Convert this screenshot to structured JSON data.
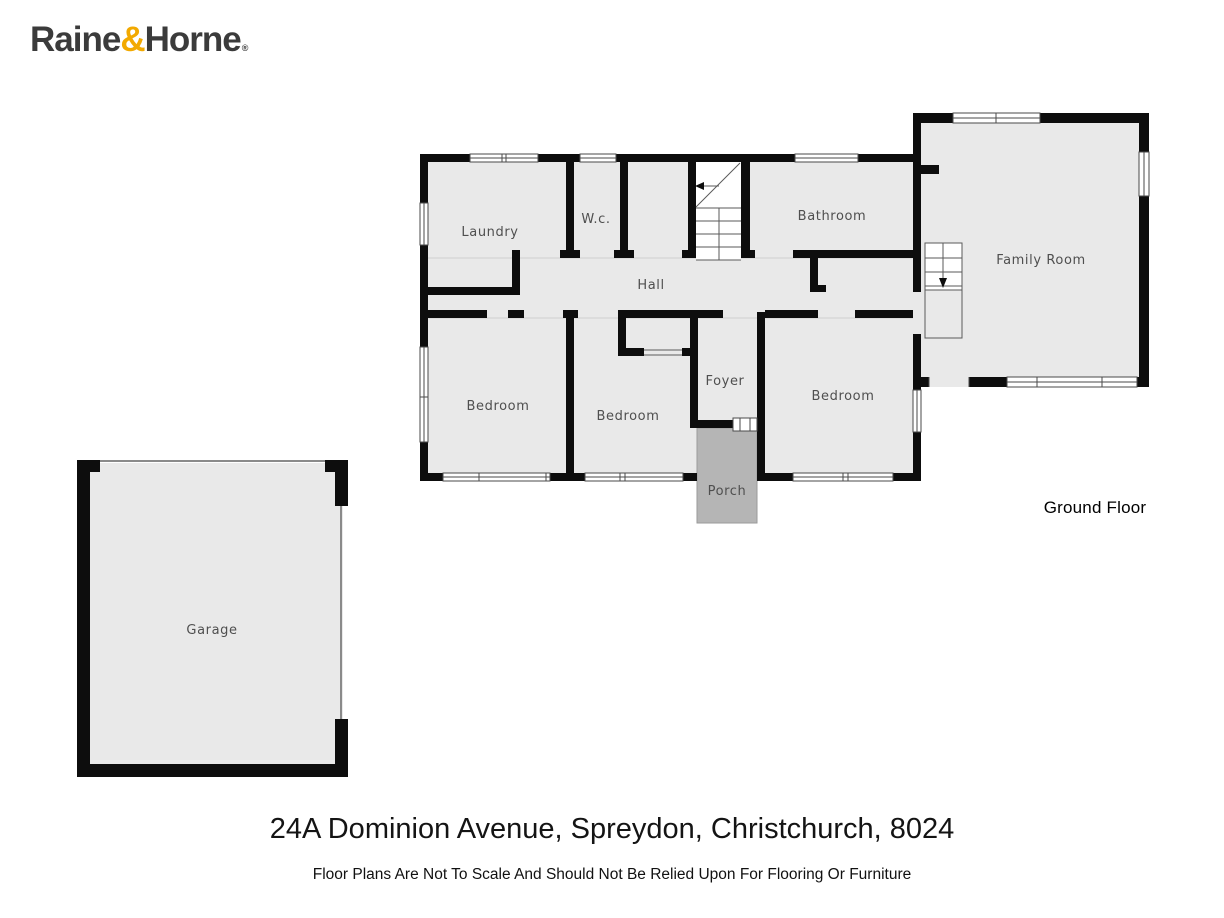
{
  "brand": {
    "name_part1": "Raine",
    "ampersand": "&",
    "name_part2": "Horne",
    "registered_mark": "®",
    "accent_color": "#F2A900",
    "text_color": "#3B3B3B"
  },
  "floorplan": {
    "floor_label": "Ground Floor",
    "rooms": {
      "laundry": "Laundry",
      "wc": "W.c.",
      "hall": "Hall",
      "bathroom": "Bathroom",
      "family_room": "Family Room",
      "bedroom_left": "Bedroom",
      "bedroom_middle": "Bedroom",
      "bedroom_right": "Bedroom",
      "foyer": "Foyer",
      "porch": "Porch",
      "garage": "Garage"
    },
    "colors": {
      "wall": "#0D0D0D",
      "floor": "#E9E9E9",
      "porch_floor": "#B5B5B5",
      "label_text": "#4F4F4F"
    }
  },
  "footer": {
    "address": "24A Dominion Avenue, Spreydon, Christchurch, 8024",
    "disclaimer": "Floor Plans Are Not To Scale And Should Not Be Relied Upon For Flooring Or Furniture"
  }
}
